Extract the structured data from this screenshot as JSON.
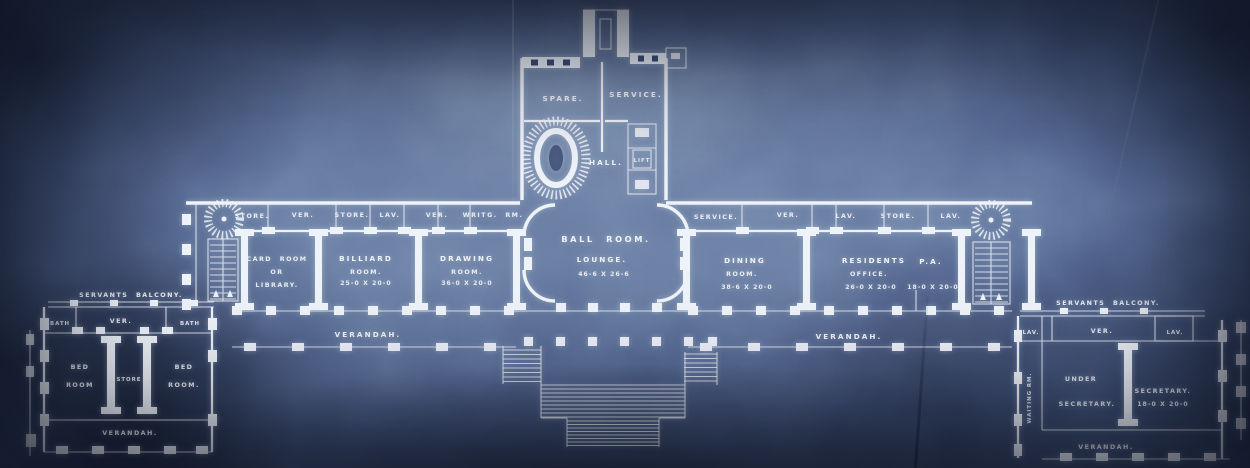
{
  "document": {
    "kind": "blueprint-floor-plan",
    "colors": {
      "paper": "#3d4d71",
      "paper_dark": "#1d2a46",
      "ink": "#ecf0f8"
    }
  },
  "tower": {
    "spare": "SPARE.",
    "service": "SERVICE.",
    "hall": "HALL.",
    "lift": "LIFT"
  },
  "north_strip_west": {
    "store1": "STORE.",
    "ver1": "VER.",
    "store2": "STORE.",
    "lav": "LAV.",
    "ver2": "VER.",
    "writing_room": "WRITG. RM."
  },
  "north_strip_east": {
    "service": "SERVICE.",
    "ver": "VER.",
    "lav1": "LAV.",
    "store": "STORE.",
    "lav2": "LAV."
  },
  "rooms": {
    "card_room": {
      "l1": "CARD ROOM",
      "l2": "OR",
      "l3": "LIBRARY."
    },
    "billiard_room": {
      "l1": "BILLIARD",
      "l2": "ROOM.",
      "dim": "25-0 X 20-0"
    },
    "drawing_room": {
      "l1": "DRAWING",
      "l2": "ROOM.",
      "dim": "36-0 X 20-0"
    },
    "ball_room": {
      "l1": "BALL ROOM.",
      "l2": "LOUNGE.",
      "dim": "46-6 X 26-6"
    },
    "dining_room": {
      "l1": "DINING",
      "l2": "ROOM.",
      "dim": "38-6 X 20-0"
    },
    "residents_office": {
      "l1": "RESIDENTS",
      "l1b": "P.A.",
      "l2": "OFFICE.",
      "dim1": "26-0 X 20-0",
      "dim2": "18-0 X 20-0"
    }
  },
  "terrace": {
    "verandah_west": "VERANDAH.",
    "verandah_east": "VERANDAH."
  },
  "west_wing": {
    "balcony": "SERVANTS BALCONY.",
    "bath1": "BATH",
    "ver": "VER.",
    "bath2": "BATH",
    "bed1_l1": "BED",
    "bed1_l2": "ROOM",
    "store": "STORE",
    "bed2_l1": "BED",
    "bed2_l2": "ROOM.",
    "verandah": "VERANDAH."
  },
  "east_wing": {
    "balcony": "SERVANTS BALCONY.",
    "lav1": "LAV.",
    "ver": "VER.",
    "lav2": "LAV.",
    "waiting_room": "WAITING RM.",
    "under_l1": "UNDER",
    "under_l2": "SECRETARY.",
    "secretary_l1": "SECRETARY.",
    "secretary_dim": "18-0 X 20-0",
    "verandah": "VERANDAH."
  }
}
